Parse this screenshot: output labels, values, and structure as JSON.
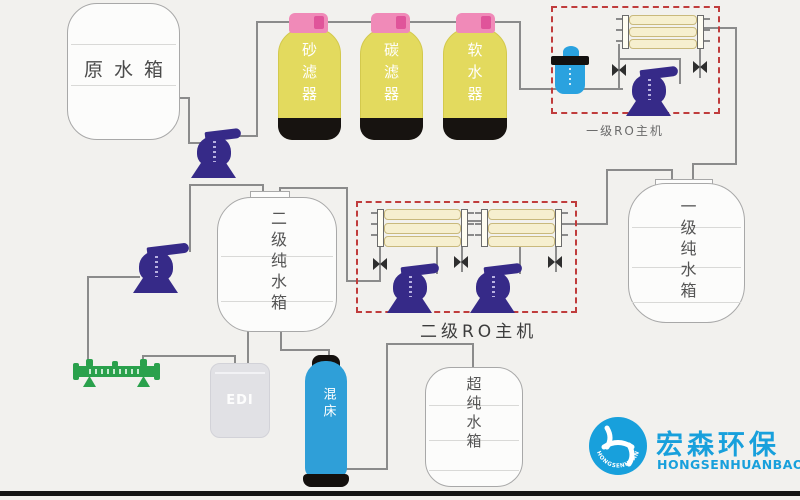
{
  "tanks": {
    "raw": {
      "label": "原水箱"
    },
    "stage1": {
      "label": "一级纯水箱"
    },
    "stage2": {
      "label": "二级纯水箱"
    },
    "ultra": {
      "label": "超纯水箱"
    }
  },
  "filters": [
    {
      "label": "砂滤器"
    },
    {
      "label": "碳滤器"
    },
    {
      "label": "软水器"
    }
  ],
  "ro_units": {
    "stage1": {
      "label": "一级RO主机"
    },
    "stage2": {
      "label": "二级RO主机"
    }
  },
  "units": {
    "edi": {
      "label": "EDI"
    },
    "mixed_bed": {
      "label": "混床"
    }
  },
  "logo": {
    "company_cn": "宏森环保",
    "company_en": "HONGSENHUANBAO",
    "emblem_text": "HONGSENHUANBAO"
  },
  "colors": {
    "filter_yellow": "#e3da5e",
    "cap_pink": "#f08ab8",
    "pump_indigo": "#362a88",
    "membrane_cream": "#f6efcf",
    "dashed_red": "#c03c3c",
    "unit_blue": "#2aa2df",
    "manifold_green": "#2aa14c",
    "brand_blue": "#18a0dc",
    "pipe_gray": "#8b8b8b"
  }
}
